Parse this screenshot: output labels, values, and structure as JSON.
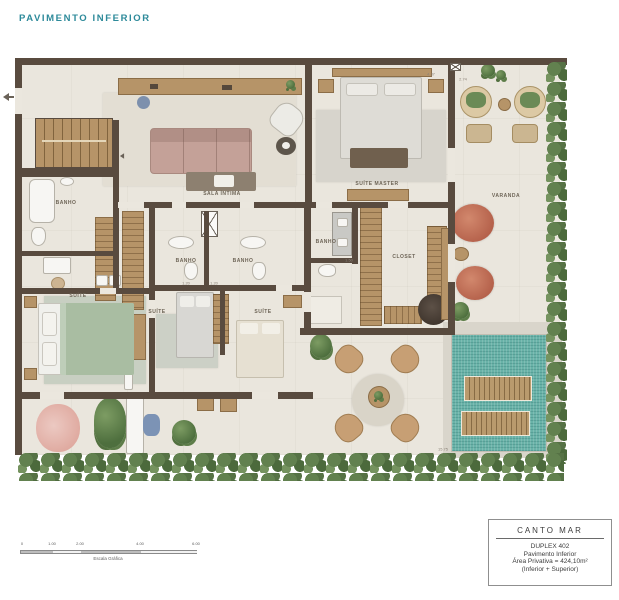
{
  "page": {
    "title": "PAVIMENTO INFERIOR"
  },
  "plan": {
    "rooms": {
      "sala_intima": "SALA ÍNTIMA",
      "suite_master": "SUÍTE MASTER",
      "banho_left": "BANHO",
      "banho_1": "BANHO",
      "banho_2": "BANHO",
      "banho_master": "BANHO",
      "closet": "CLOSET",
      "varanda": "VARANDA",
      "suite_left": "SUÍTE",
      "suite_1": "SUÍTE",
      "suite_2": "SUÍTE"
    },
    "dimensions": {
      "d1": "1.20",
      "d2": "1.20",
      "d3": "1.50",
      "d4": "15.75",
      "d5": "4.37",
      "d6": "2.74"
    }
  },
  "scale_bar": {
    "ticks": [
      "0",
      "1.00",
      "2.00",
      "4.00",
      "6.00"
    ],
    "caption": "Escala Gráfica"
  },
  "info_box": {
    "project": "CANTO MAR",
    "unit": "DUPLEX 402",
    "floor": "Pavimento Inferior",
    "area": "Área Privativa = 424,10m²",
    "note": "(Inferior + Superior)"
  },
  "colors": {
    "accent_teal": "#2d8a9a",
    "wall": "#594b3f",
    "wood": "#b69468",
    "pool": "#69b2a8",
    "hedge": "#5d8050",
    "terracotta": "#c27057"
  }
}
